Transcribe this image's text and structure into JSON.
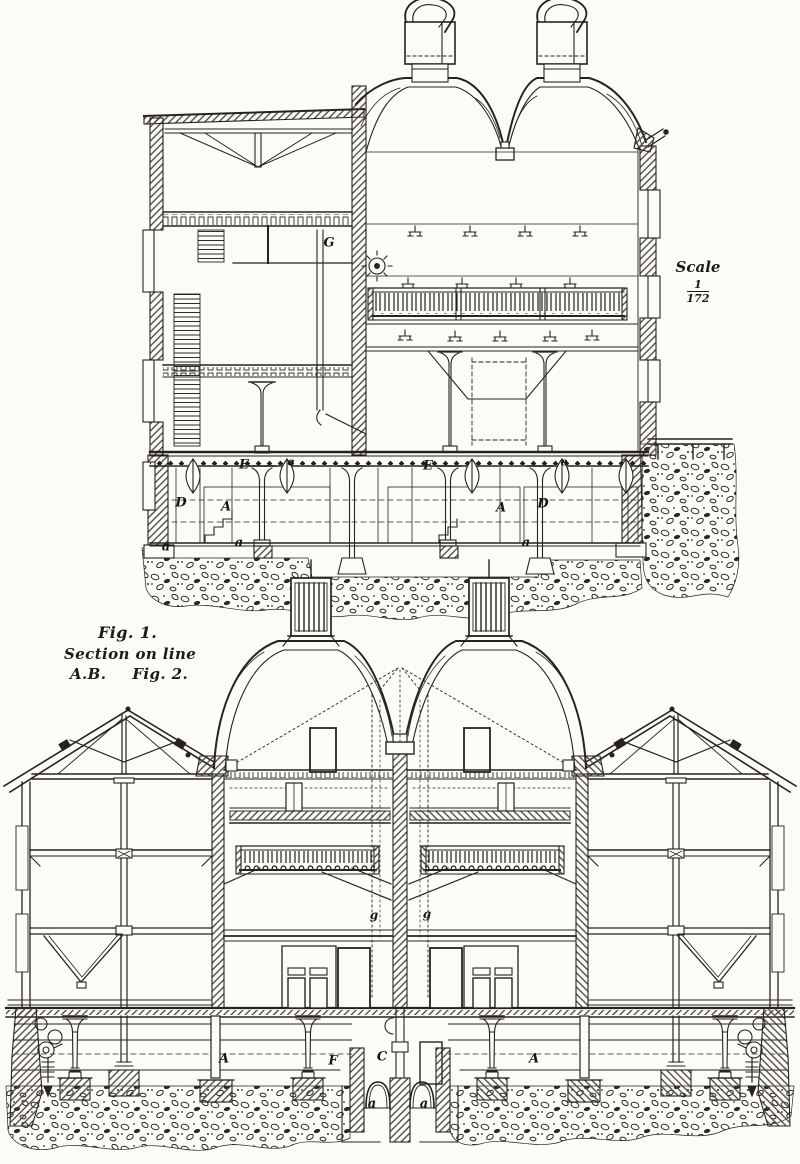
{
  "caption": {
    "fig1_label": "Fig. 1.",
    "subtitle": "Section on line",
    "line_ab": "A.B.",
    "fig2_label": "Fig. 2."
  },
  "scale": {
    "word": "Scale",
    "numerator": "1",
    "denominator": "172"
  },
  "fig1": {
    "labels": [
      {
        "text": "G"
      },
      {
        "text": "E"
      },
      {
        "text": "e"
      },
      {
        "text": "E"
      },
      {
        "text": "e"
      },
      {
        "text": "D"
      },
      {
        "text": "A"
      },
      {
        "text": "A"
      },
      {
        "text": "D"
      },
      {
        "text": "a"
      },
      {
        "text": "a"
      },
      {
        "text": "a"
      }
    ]
  },
  "fig2": {
    "labels": [
      {
        "text": "g"
      },
      {
        "text": "g"
      },
      {
        "text": "A"
      },
      {
        "text": "F"
      },
      {
        "text": "C"
      },
      {
        "text": "A"
      },
      {
        "text": "a"
      },
      {
        "text": "a"
      }
    ]
  }
}
